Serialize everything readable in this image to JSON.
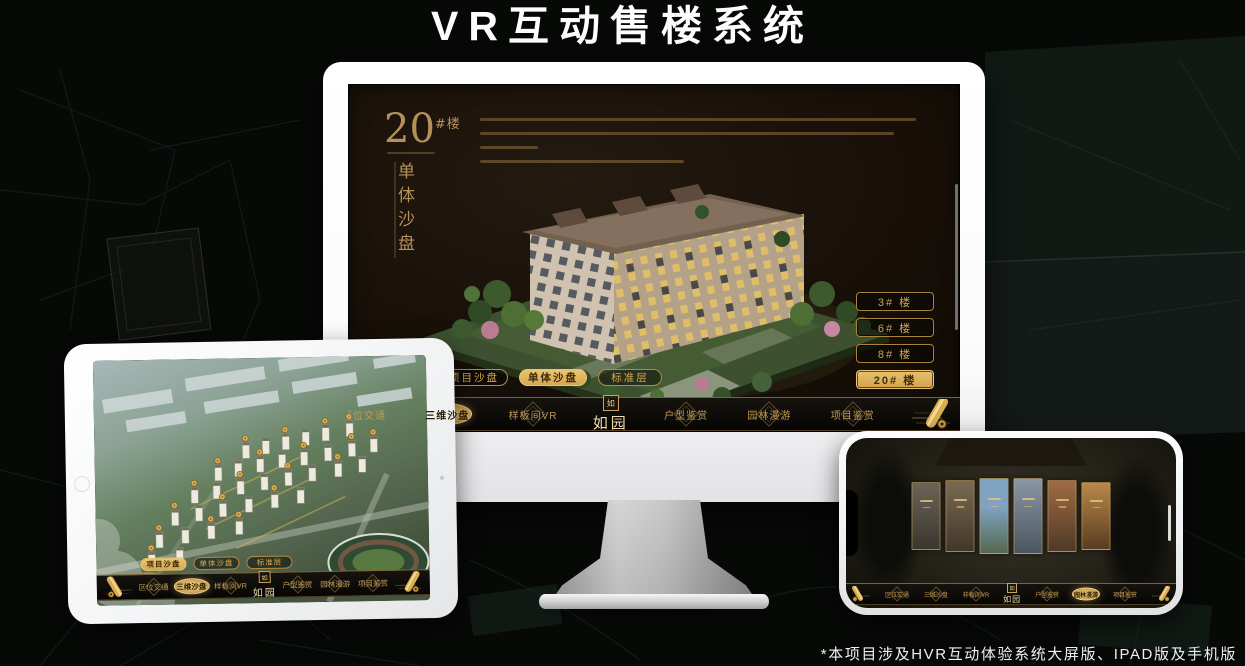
{
  "header": {
    "title": "VR互动售楼系统"
  },
  "footer": {
    "note": "*本项目涉及HVR互动体验系统大屏版、IPAD版及手机版"
  },
  "app": {
    "logo_text": "如园",
    "logo_seal": "如",
    "monitor": {
      "block_number": "20",
      "block_suffix": "#楼",
      "block_subtitle": "单体沙盘",
      "floor_buttons": [
        {
          "label": "3# 楼",
          "selected": false
        },
        {
          "label": "6# 楼",
          "selected": false
        },
        {
          "label": "8# 楼",
          "selected": false
        },
        {
          "label": "20# 楼",
          "selected": true
        }
      ],
      "sub_tabs": [
        {
          "label": "项目沙盘",
          "selected": false
        },
        {
          "label": "单体沙盘",
          "selected": true
        },
        {
          "label": "标准层",
          "selected": false
        }
      ],
      "nav_items": [
        {
          "label": "区位交通",
          "selected": false
        },
        {
          "label": "三维沙盘",
          "selected": true
        },
        {
          "label": "样板间VR",
          "selected": false
        },
        {
          "label": "户型鉴赏",
          "selected": false
        },
        {
          "label": "园林漫游",
          "selected": false
        },
        {
          "label": "项目鉴赏",
          "selected": false
        }
      ]
    },
    "ipad": {
      "sub_tabs": [
        {
          "label": "项目沙盘",
          "selected": true
        },
        {
          "label": "单体沙盘",
          "selected": false
        },
        {
          "label": "标准层",
          "selected": false
        }
      ],
      "nav_items": [
        {
          "label": "区位交通",
          "selected": false
        },
        {
          "label": "三维沙盘",
          "selected": true
        },
        {
          "label": "样板间VR",
          "selected": false
        },
        {
          "label": "户型鉴赏",
          "selected": false
        },
        {
          "label": "园林漫游",
          "selected": false
        },
        {
          "label": "项目鉴赏",
          "selected": false
        }
      ]
    },
    "phone": {
      "nav_items": [
        {
          "label": "区位交通",
          "selected": false
        },
        {
          "label": "三维沙盘",
          "selected": false
        },
        {
          "label": "样板间VR",
          "selected": false
        },
        {
          "label": "户型鉴赏",
          "selected": false
        },
        {
          "label": "园林漫游",
          "selected": true
        },
        {
          "label": "项目鉴赏",
          "selected": false
        }
      ]
    }
  },
  "palette": {
    "accent_gold": "#C9A25C",
    "accent_gold_bright": "#E3BD6C",
    "selected_fill": "#E2B964",
    "screen_background": "#17110A",
    "device_white": "#F4F4F5",
    "page_background": "#070907",
    "title_white": "#FFFFFF"
  }
}
